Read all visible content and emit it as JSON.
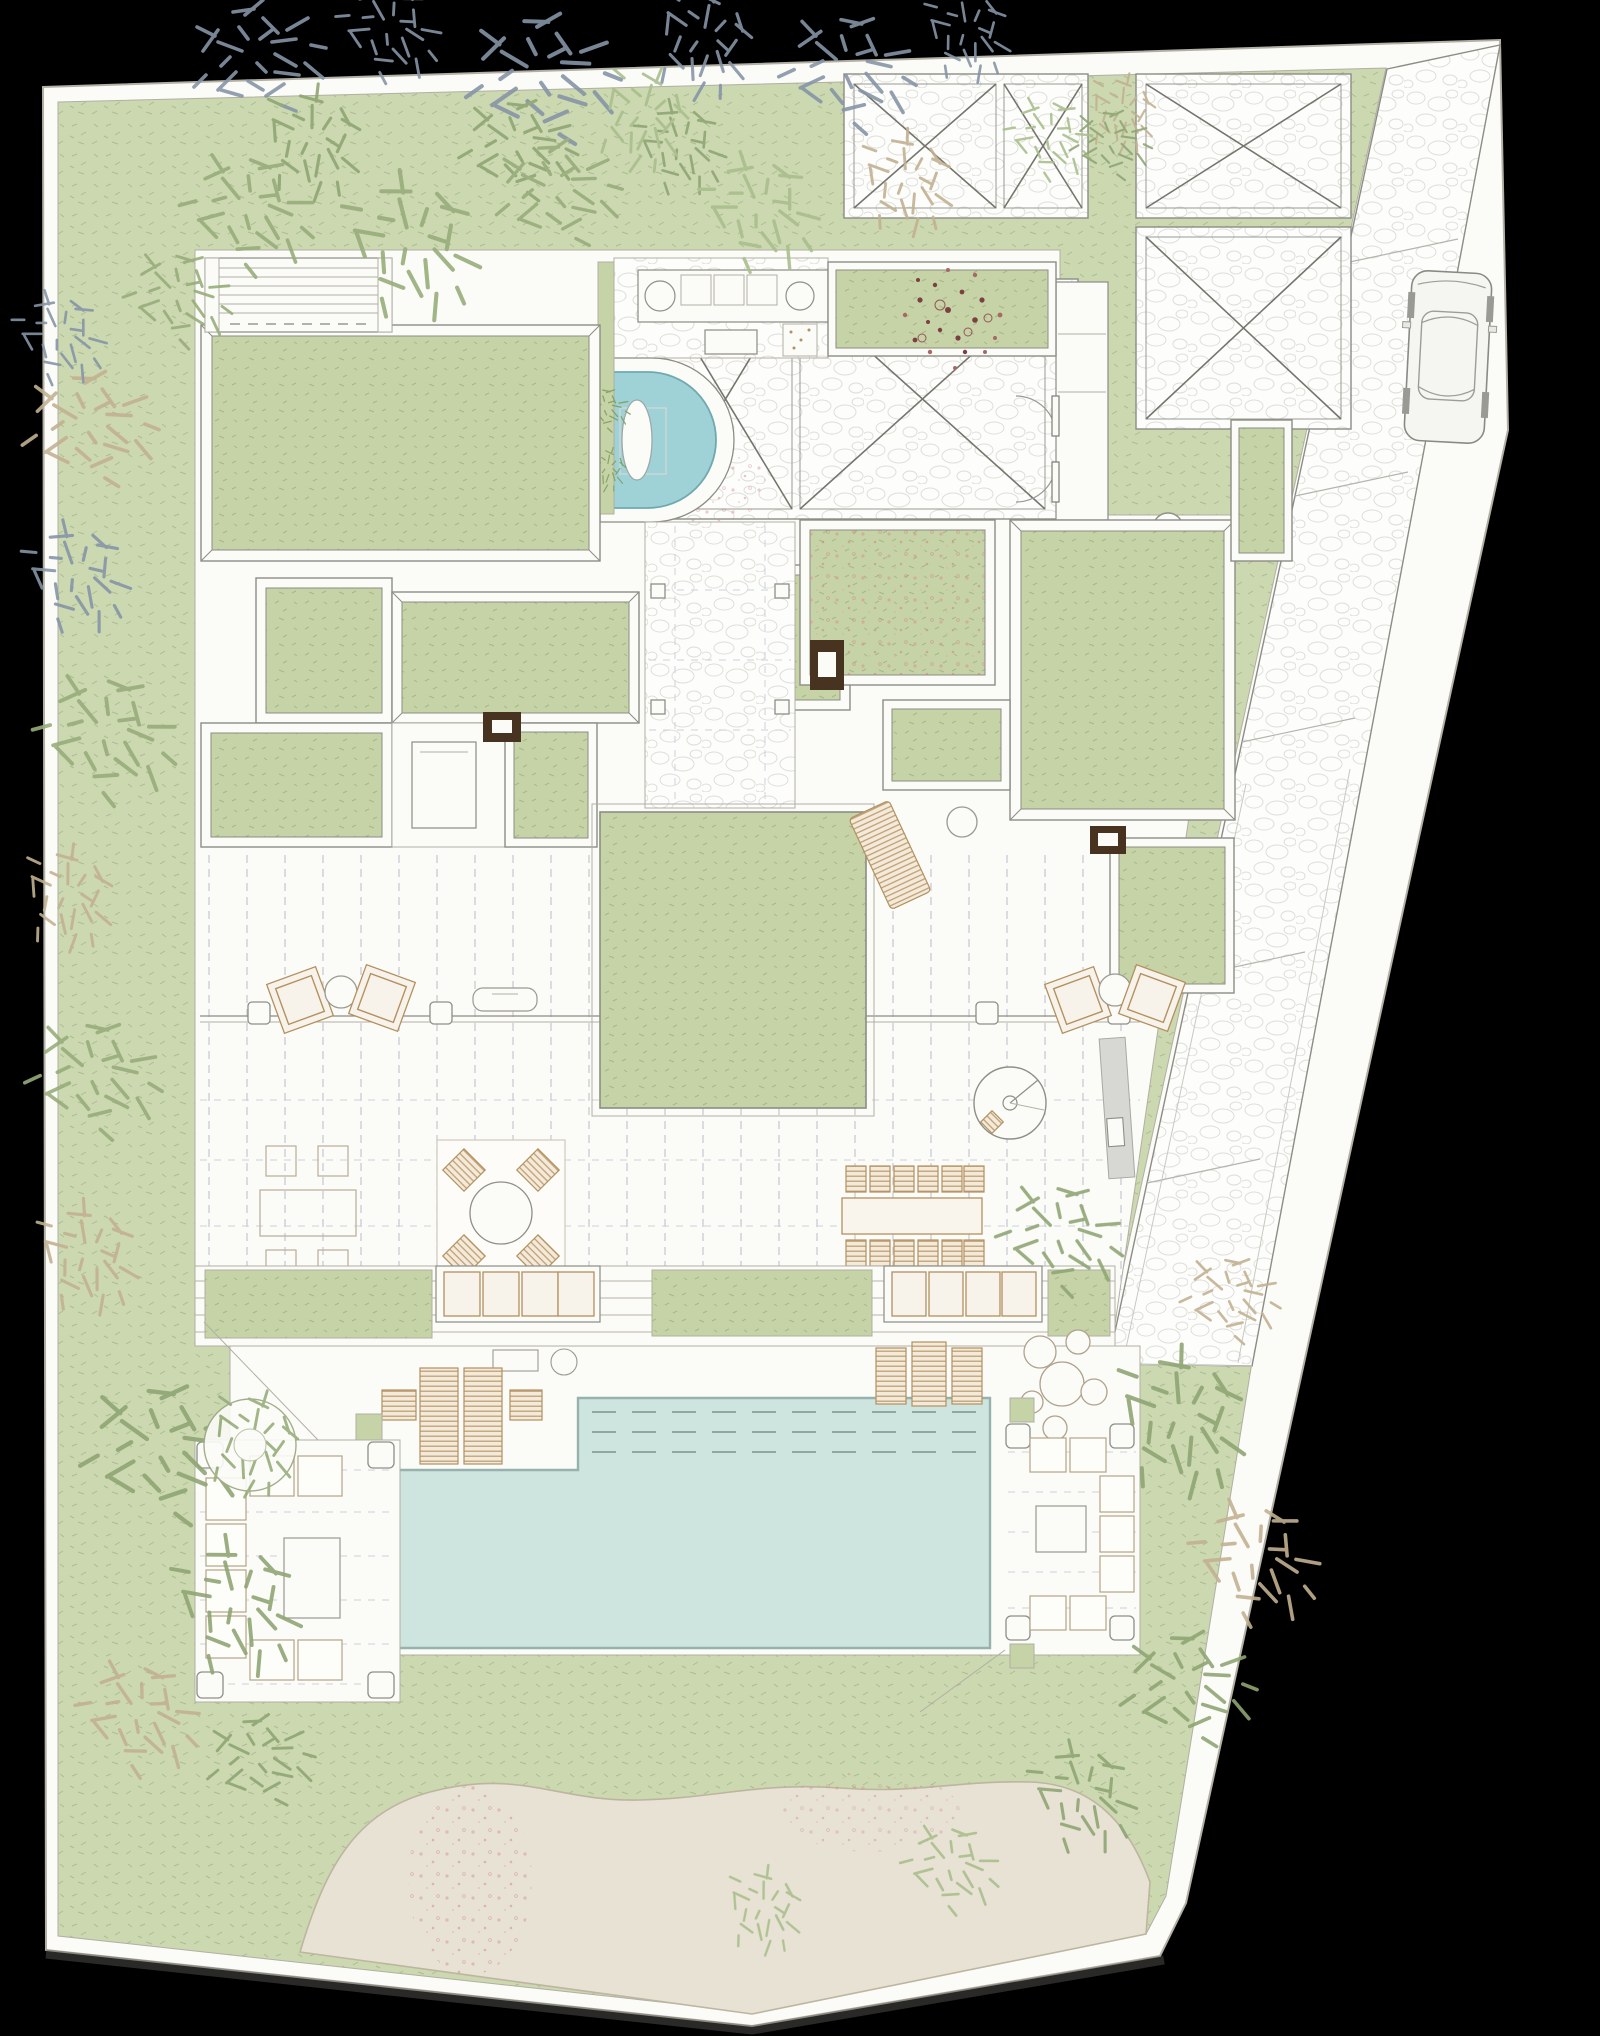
{
  "document": {
    "kind": "architectural-site-plan",
    "view": "roof / landscape plan of a courtyard villa",
    "visible_text": "none (drawing contains no legible text or labels)"
  },
  "colors": {
    "paper": "#fbfbf8",
    "line": "#8d8d85",
    "lineSoft": "#b2afa3",
    "lawn": "#cbd8b0",
    "roof": "#c6d3a6",
    "water": "#cde4df",
    "waterEdge": "#97b2ad",
    "plunge": "#9ed2d6",
    "sand": "#e7e2d3",
    "sandEdge": "#beb5a0",
    "wood": "#b3905f",
    "dark": "#47331f",
    "deckDash": "#c4cad2",
    "foliageBlue": "#8595a6",
    "foliageGreen": "#97ad7a",
    "foliageLight": "#aabf8d",
    "foliageOlive": "#8fa573",
    "foliageTan": "#c2b191",
    "flower": "#7c4040",
    "pink": "#d28c8c",
    "shadow": "#5c5c57"
  },
  "inventory": {
    "green_roofs": 12,
    "x_braced_paved_panels": 6,
    "paved_courts": 4,
    "swimming_pool": 1,
    "plunge_pool": 1,
    "parked_cars": 1,
    "dining_table_seats": 12,
    "round_dining_set_seats": 4,
    "sun_loungers": 7,
    "angled_lounge_chair_pairs": 2,
    "outdoor_sofa_pergolas": 2,
    "spiral_stairs": 1,
    "dark_chimney_skylights": 3,
    "oval_skylights": 1,
    "planter_troughs": 2,
    "tree_canopies": "approx. 35 hand-drawn canopies"
  },
  "interpreted_regions": [
    {
      "id": "garden-lawn",
      "label": "perimeter lawn garden"
    },
    {
      "id": "driveway",
      "label": "sloped stone driveway with parked car"
    },
    {
      "id": "entry-court",
      "label": "entry court with X-braced paving"
    },
    {
      "id": "garage-court",
      "label": "garage court with X-braced paving"
    },
    {
      "id": "outdoor-kitchen",
      "label": "outdoor kitchen counter"
    },
    {
      "id": "plunge-pool",
      "label": "curved plunge pool with in-water lounger"
    },
    {
      "id": "central-courtyard",
      "label": "central lawn courtyard"
    },
    {
      "id": "timber-deck",
      "label": "timber deck with furniture"
    },
    {
      "id": "steps-planters",
      "label": "garden steps with planter troughs"
    },
    {
      "id": "pool-terrace",
      "label": "pool terrace with loungers"
    },
    {
      "id": "swimming-pool",
      "label": "large swimming pool with shallow shelf"
    },
    {
      "id": "sand-garden",
      "label": "sand / beach garden at the bottom"
    }
  ]
}
